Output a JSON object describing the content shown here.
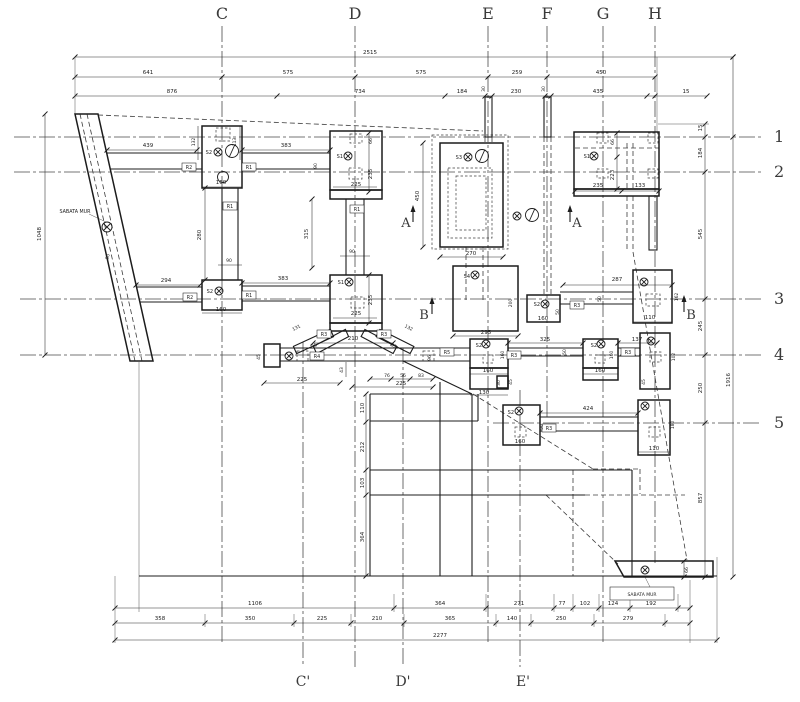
{
  "colors": {
    "line": "#1c1c1c",
    "grid": "#4a4a4a",
    "dim": "#2a2a2a",
    "background": "#ffffff"
  },
  "grid": {
    "columns": [
      "C",
      "D",
      "E",
      "F",
      "G",
      "H"
    ],
    "rows": [
      "1",
      "2",
      "3",
      "4",
      "5"
    ],
    "bottom_columns": [
      "C'",
      "D'",
      "E'"
    ]
  },
  "wall_label": "SABATA MUR",
  "texts": [
    {
      "n": "grid-col-c",
      "s": "C",
      "x": 222,
      "y": 19,
      "fs": 16,
      "cls": "g"
    },
    {
      "n": "grid-col-d",
      "s": "D",
      "x": 355,
      "y": 19,
      "fs": 16,
      "cls": "g"
    },
    {
      "n": "grid-col-e",
      "s": "E",
      "x": 488,
      "y": 19,
      "fs": 16,
      "cls": "g"
    },
    {
      "n": "grid-col-f",
      "s": "F",
      "x": 547,
      "y": 19,
      "fs": 16,
      "cls": "g"
    },
    {
      "n": "grid-col-g",
      "s": "G",
      "x": 603,
      "y": 19,
      "fs": 16,
      "cls": "g"
    },
    {
      "n": "grid-col-h",
      "s": "H",
      "x": 655,
      "y": 19,
      "fs": 16,
      "cls": "g"
    },
    {
      "n": "grid-row-1",
      "s": "1",
      "x": 774,
      "y": 142,
      "fs": 16,
      "cls": "g",
      "a": "s"
    },
    {
      "n": "grid-row-2",
      "s": "2",
      "x": 774,
      "y": 177,
      "fs": 16,
      "cls": "g",
      "a": "s"
    },
    {
      "n": "grid-row-3",
      "s": "3",
      "x": 774,
      "y": 304,
      "fs": 16,
      "cls": "g",
      "a": "s"
    },
    {
      "n": "grid-row-4",
      "s": "4",
      "x": 774,
      "y": 360,
      "fs": 16,
      "cls": "g",
      "a": "s"
    },
    {
      "n": "grid-row-5",
      "s": "5",
      "x": 774,
      "y": 428,
      "fs": 16,
      "cls": "g",
      "a": "s"
    },
    {
      "n": "grid-col-c-prime",
      "s": "C'",
      "x": 303,
      "y": 686,
      "fs": 14,
      "cls": "g"
    },
    {
      "n": "grid-col-d-prime",
      "s": "D'",
      "x": 403,
      "y": 686,
      "fs": 14,
      "cls": "g"
    },
    {
      "n": "grid-col-e-prime",
      "s": "E'",
      "x": 523,
      "y": 686,
      "fs": 14,
      "cls": "g"
    },
    {
      "n": "dim-total-top",
      "s": "2515",
      "x": 370,
      "y": 54
    },
    {
      "n": "dim-top-641",
      "s": "641",
      "x": 148,
      "y": 74
    },
    {
      "n": "dim-top-575a",
      "s": "575",
      "x": 288,
      "y": 74
    },
    {
      "n": "dim-top-575b",
      "s": "575",
      "x": 421,
      "y": 74
    },
    {
      "n": "dim-top-259",
      "s": "259",
      "x": 517,
      "y": 74
    },
    {
      "n": "dim-top-450",
      "s": "450",
      "x": 601,
      "y": 74
    },
    {
      "n": "dim-top-876",
      "s": "876",
      "x": 172,
      "y": 93
    },
    {
      "n": "dim-top-734",
      "s": "734",
      "x": 360,
      "y": 93
    },
    {
      "n": "dim-top-184",
      "s": "184",
      "x": 462,
      "y": 93
    },
    {
      "n": "dim-top-230",
      "s": "230",
      "x": 516,
      "y": 93
    },
    {
      "n": "dim-top-435",
      "s": "435",
      "x": 598,
      "y": 93
    },
    {
      "n": "dim-top-15",
      "s": "15",
      "x": 686,
      "y": 93
    },
    {
      "n": "dim-top-30a",
      "s": "30",
      "x": 485,
      "y": 89,
      "r": -90,
      "fs": 4.5
    },
    {
      "n": "dim-top-30b",
      "s": "30",
      "x": 545,
      "y": 89,
      "r": -90,
      "fs": 4.5
    },
    {
      "n": "dim-right-15",
      "s": "15",
      "x": 702,
      "y": 128,
      "r": -90
    },
    {
      "n": "dim-right-184",
      "s": "184",
      "x": 702,
      "y": 153,
      "r": -90
    },
    {
      "n": "dim-right-545",
      "s": "545",
      "x": 702,
      "y": 234,
      "r": -90
    },
    {
      "n": "dim-right-245",
      "s": "245",
      "x": 702,
      "y": 326,
      "r": -90
    },
    {
      "n": "dim-right-250",
      "s": "250",
      "x": 702,
      "y": 388,
      "r": -90
    },
    {
      "n": "dim-right-857",
      "s": "857",
      "x": 702,
      "y": 498,
      "r": -90
    },
    {
      "n": "dim-right-1916",
      "s": "1916",
      "x": 730,
      "y": 380,
      "r": -90
    },
    {
      "n": "dim-left-1048",
      "s": "1048",
      "x": 41,
      "y": 234,
      "r": -90
    },
    {
      "n": "dim-bot-1106",
      "s": "1106",
      "x": 255,
      "y": 605
    },
    {
      "n": "dim-bot-364",
      "s": "364",
      "x": 440,
      "y": 605
    },
    {
      "n": "dim-bot-271",
      "s": "271",
      "x": 519,
      "y": 605
    },
    {
      "n": "dim-bot-77",
      "s": "77",
      "x": 562,
      "y": 605
    },
    {
      "n": "dim-bot-102",
      "s": "102",
      "x": 585,
      "y": 605
    },
    {
      "n": "dim-bot-124",
      "s": "124",
      "x": 613,
      "y": 605
    },
    {
      "n": "dim-bot-192",
      "s": "192",
      "x": 651,
      "y": 605
    },
    {
      "n": "dim-bot-358",
      "s": "358",
      "x": 160,
      "y": 620
    },
    {
      "n": "dim-bot-350",
      "s": "350",
      "x": 250,
      "y": 620
    },
    {
      "n": "dim-bot-225",
      "s": "225",
      "x": 322,
      "y": 620
    },
    {
      "n": "dim-bot-210",
      "s": "210",
      "x": 377,
      "y": 620
    },
    {
      "n": "dim-bot-365",
      "s": "365",
      "x": 450,
      "y": 620
    },
    {
      "n": "dim-bot-140",
      "s": "140",
      "x": 512,
      "y": 620
    },
    {
      "n": "dim-bot-250",
      "s": "250",
      "x": 561,
      "y": 620
    },
    {
      "n": "dim-bot-279",
      "s": "279",
      "x": 628,
      "y": 620
    },
    {
      "n": "dim-total-bottom",
      "s": "2277",
      "x": 440,
      "y": 637
    },
    {
      "n": "wall-label-left",
      "s": "SABATA MUR",
      "x": 75,
      "y": 213,
      "fs": 4.8
    },
    {
      "n": "wall-dim-50",
      "s": "50",
      "x": 109,
      "y": 257,
      "r": -75,
      "fs": 4.5
    },
    {
      "n": "dim-439",
      "s": "439",
      "x": 148,
      "y": 147
    },
    {
      "n": "dim-132",
      "s": "132",
      "x": 195,
      "y": 142,
      "r": -90,
      "fs": 4.5
    },
    {
      "n": "dim-113",
      "s": "113",
      "x": 236,
      "y": 142,
      "r": -90,
      "fs": 4.5
    },
    {
      "n": "label-s2-c2",
      "s": "S2",
      "x": 212,
      "y": 154,
      "a": "e",
      "fs": 5
    },
    {
      "n": "dim-160-c2",
      "s": "160",
      "x": 221,
      "y": 184
    },
    {
      "n": "dim-383-r2",
      "s": "383",
      "x": 286,
      "y": 147
    },
    {
      "n": "dim-90-r2",
      "s": "90",
      "x": 317,
      "y": 166,
      "r": -90,
      "fs": 4.5
    },
    {
      "n": "dim-280-c",
      "s": "280",
      "x": 201,
      "y": 235,
      "r": -90
    },
    {
      "n": "dim-90-c",
      "s": "90",
      "x": 229,
      "y": 262,
      "fs": 4.5
    },
    {
      "n": "dim-294",
      "s": "294",
      "x": 166,
      "y": 282
    },
    {
      "n": "label-s2-c3",
      "s": "S2",
      "x": 213,
      "y": 293,
      "a": "e",
      "fs": 5
    },
    {
      "n": "dim-160-c3",
      "s": "160",
      "x": 221,
      "y": 311
    },
    {
      "n": "dim-383-r3",
      "s": "383",
      "x": 283,
      "y": 280
    },
    {
      "n": "label-s1-d2",
      "s": "S1",
      "x": 343,
      "y": 158,
      "a": "e",
      "fs": 5
    },
    {
      "n": "dim-66-d2",
      "s": "66",
      "x": 372,
      "y": 141,
      "r": -90,
      "fs": 4.5
    },
    {
      "n": "dim-235-d2",
      "s": "235",
      "x": 372,
      "y": 174,
      "r": -90
    },
    {
      "n": "dim-225-d2",
      "s": "225",
      "x": 356,
      "y": 186
    },
    {
      "n": "dim-315",
      "s": "315",
      "x": 308,
      "y": 234,
      "r": -90
    },
    {
      "n": "dim-90-d",
      "s": "90",
      "x": 352,
      "y": 253,
      "fs": 4.5
    },
    {
      "n": "label-s1-d3",
      "s": "S1",
      "x": 344,
      "y": 284,
      "a": "e",
      "fs": 5
    },
    {
      "n": "dim-235-d3",
      "s": "235",
      "x": 372,
      "y": 300,
      "r": -90
    },
    {
      "n": "dim-225-d3",
      "s": "225",
      "x": 356,
      "y": 315
    },
    {
      "n": "dim-131",
      "s": "131",
      "x": 297,
      "y": 329,
      "r": -28,
      "fs": 4.5
    },
    {
      "n": "dim-132b",
      "s": "132",
      "x": 408,
      "y": 329,
      "r": 28,
      "fs": 4.5
    },
    {
      "n": "dim-35a",
      "s": "35",
      "x": 315,
      "y": 347,
      "r": -28,
      "fs": 4.5
    },
    {
      "n": "dim-35b",
      "s": "35",
      "x": 393,
      "y": 347,
      "r": 28,
      "fs": 4.5
    },
    {
      "n": "dim-210-braces",
      "s": "210",
      "x": 353,
      "y": 340
    },
    {
      "n": "dim-45-beam-end",
      "s": "45",
      "x": 260,
      "y": 357,
      "r": -90,
      "fs": 4.5
    },
    {
      "n": "dim-225-beam",
      "s": "225",
      "x": 302,
      "y": 381
    },
    {
      "n": "dim-43",
      "s": "43",
      "x": 343,
      "y": 370,
      "r": -90,
      "fs": 4.5
    },
    {
      "n": "dim-76",
      "s": "76",
      "x": 387,
      "y": 377,
      "fs": 4.5
    },
    {
      "n": "dim-56",
      "s": "56",
      "x": 403,
      "y": 377,
      "fs": 4.5
    },
    {
      "n": "dim-83",
      "s": "83",
      "x": 421,
      "y": 377,
      "fs": 4.5
    },
    {
      "n": "dim-225-plat",
      "s": "225",
      "x": 401,
      "y": 385
    },
    {
      "n": "dim-110-plat",
      "s": "110",
      "x": 364,
      "y": 408,
      "r": -90
    },
    {
      "n": "dim-212-plat",
      "s": "212",
      "x": 364,
      "y": 447,
      "r": -90
    },
    {
      "n": "dim-103-plat",
      "s": "103",
      "x": 364,
      "y": 483,
      "r": -90
    },
    {
      "n": "dim-364-plat",
      "s": "364",
      "x": 364,
      "y": 537,
      "r": -90
    },
    {
      "n": "label-s3",
      "s": "S3",
      "x": 462,
      "y": 159,
      "a": "e",
      "fs": 5
    },
    {
      "n": "dim-450-s3",
      "s": "450",
      "x": 419,
      "y": 196,
      "r": -90
    },
    {
      "n": "dim-270-s3",
      "s": "270",
      "x": 471,
      "y": 255
    },
    {
      "n": "section-a-left",
      "s": "A",
      "x": 406,
      "y": 227,
      "fs": 13,
      "cls": "g"
    },
    {
      "n": "section-a-right",
      "s": "A",
      "x": 577,
      "y": 227,
      "fs": 13,
      "cls": "g"
    },
    {
      "n": "label-s4",
      "s": "S4",
      "x": 470,
      "y": 278,
      "a": "e",
      "fs": 5
    },
    {
      "n": "dim-295-s4",
      "s": "295",
      "x": 486,
      "y": 334
    },
    {
      "n": "dim-200-s4",
      "s": "200",
      "x": 512,
      "y": 303,
      "r": -90,
      "fs": 4.5
    },
    {
      "n": "label-s2-f3",
      "s": "S2",
      "x": 540,
      "y": 306,
      "a": "e",
      "fs": 5
    },
    {
      "n": "dim-160-f3",
      "s": "160",
      "x": 543,
      "y": 320
    },
    {
      "n": "dim-50-f3",
      "s": "50",
      "x": 559,
      "y": 312,
      "r": -90,
      "fs": 4.5
    },
    {
      "n": "dim-287",
      "s": "287",
      "x": 617,
      "y": 281
    },
    {
      "n": "dim-50-g3",
      "s": "50",
      "x": 601,
      "y": 299,
      "r": -90,
      "fs": 4.5
    },
    {
      "n": "dim-110-g3",
      "s": "110",
      "x": 650,
      "y": 319
    },
    {
      "n": "dim-162-g3",
      "s": "162",
      "x": 678,
      "y": 297,
      "r": -90,
      "fs": 4.5
    },
    {
      "n": "section-b-left",
      "s": "B",
      "x": 424,
      "y": 319,
      "fs": 13,
      "cls": "g"
    },
    {
      "n": "section-b-right",
      "s": "B",
      "x": 691,
      "y": 319,
      "fs": 13,
      "cls": "g"
    },
    {
      "n": "dim-96",
      "s": "96",
      "x": 431,
      "y": 358,
      "r": -90,
      "fs": 4.5
    },
    {
      "n": "label-s2-x1",
      "s": "S2",
      "x": 482,
      "y": 347,
      "a": "e",
      "fs": 5
    },
    {
      "n": "dim-160-x1r",
      "s": "160",
      "x": 504,
      "y": 355,
      "r": -90,
      "fs": 4.5
    },
    {
      "n": "dim-160-x1",
      "s": "160",
      "x": 488,
      "y": 372
    },
    {
      "n": "dim-30-x1",
      "s": "30",
      "x": 500,
      "y": 383,
      "r": -90,
      "fs": 4.5
    },
    {
      "n": "dim-45-x1",
      "s": "45",
      "x": 512,
      "y": 382,
      "r": -90,
      "fs": 4.5
    },
    {
      "n": "dim-130-x1",
      "s": "130",
      "x": 484,
      "y": 394
    },
    {
      "n": "dim-325",
      "s": "325",
      "x": 545,
      "y": 341
    },
    {
      "n": "dim-50-x",
      "s": "50",
      "x": 566,
      "y": 352,
      "r": -90,
      "fs": 4.5
    },
    {
      "n": "label-s2-x2",
      "s": "S2",
      "x": 597,
      "y": 347,
      "a": "e",
      "fs": 5
    },
    {
      "n": "dim-160-x2r",
      "s": "160",
      "x": 613,
      "y": 355,
      "r": -90,
      "fs": 4.5
    },
    {
      "n": "dim-160-x2",
      "s": "160",
      "x": 600,
      "y": 372
    },
    {
      "n": "dim-137",
      "s": "137",
      "x": 637,
      "y": 341
    },
    {
      "n": "dim-102-r4",
      "s": "102",
      "x": 675,
      "y": 357,
      "r": -90,
      "fs": 4.5
    },
    {
      "n": "dim-45-r4",
      "s": "45",
      "x": 645,
      "y": 382,
      "r": -90,
      "fs": 4.5
    },
    {
      "n": "label-s2-r5",
      "s": "S2",
      "x": 514,
      "y": 414,
      "a": "e",
      "fs": 5
    },
    {
      "n": "dim-160-r5",
      "s": "160",
      "x": 520,
      "y": 443
    },
    {
      "n": "dim-90-r5",
      "s": "90",
      "x": 543,
      "y": 427,
      "r": -90,
      "fs": 4.5
    },
    {
      "n": "dim-424",
      "s": "424",
      "x": 588,
      "y": 410
    },
    {
      "n": "dim-110-r5",
      "s": "110",
      "x": 654,
      "y": 450
    },
    {
      "n": "dim-180-r5",
      "s": "180",
      "x": 674,
      "y": 425,
      "r": -90,
      "fs": 4.5
    },
    {
      "n": "label-s1-gh",
      "s": "S1",
      "x": 590,
      "y": 158,
      "a": "e",
      "fs": 5
    },
    {
      "n": "dim-66-gh",
      "s": "66",
      "x": 614,
      "y": 142,
      "r": -90,
      "fs": 4.5
    },
    {
      "n": "dim-223-gh",
      "s": "223",
      "x": 614,
      "y": 175,
      "r": -90
    },
    {
      "n": "dim-235-gh",
      "s": "235",
      "x": 598,
      "y": 187
    },
    {
      "n": "dim-133-gh",
      "s": "133",
      "x": 640,
      "y": 187
    },
    {
      "n": "dim-66-trap",
      "s": "66",
      "x": 688,
      "y": 570,
      "r": -90,
      "fs": 4.5
    },
    {
      "n": "wall-label-right",
      "s": "SABATA MUR",
      "x": 642,
      "y": 596,
      "fs": 4.5
    }
  ],
  "ref_boxes": [
    {
      "n": "beam-ref-r2-a",
      "s": "R2",
      "x": 189,
      "y": 167
    },
    {
      "n": "beam-ref-r1-a",
      "s": "R1",
      "x": 249,
      "y": 167
    },
    {
      "n": "beam-ref-r1-b",
      "s": "R1",
      "x": 230,
      "y": 206
    },
    {
      "n": "beam-ref-r1-c",
      "s": "R1",
      "x": 357,
      "y": 209
    },
    {
      "n": "beam-ref-r2-b",
      "s": "R2",
      "x": 190,
      "y": 297
    },
    {
      "n": "beam-ref-r1-d",
      "s": "R1",
      "x": 249,
      "y": 295
    },
    {
      "n": "beam-ref-r3-a",
      "s": "R3",
      "x": 324,
      "y": 334
    },
    {
      "n": "beam-ref-r3-b",
      "s": "R3",
      "x": 384,
      "y": 334
    },
    {
      "n": "beam-ref-r4",
      "s": "R4",
      "x": 317,
      "y": 356
    },
    {
      "n": "beam-ref-r5",
      "s": "R5",
      "x": 447,
      "y": 352
    },
    {
      "n": "beam-ref-r3-c",
      "s": "R3",
      "x": 514,
      "y": 355
    },
    {
      "n": "beam-ref-r3-d",
      "s": "R3",
      "x": 577,
      "y": 305
    },
    {
      "n": "beam-ref-r3-e",
      "s": "R3",
      "x": 628,
      "y": 352
    },
    {
      "n": "beam-ref-r3-f",
      "s": "R3",
      "x": 549,
      "y": 428
    }
  ],
  "symbols": [
    {
      "t": "x",
      "x": 107,
      "y": 227,
      "r": 5
    },
    {
      "t": "x",
      "x": 218,
      "y": 152
    },
    {
      "t": "slash",
      "x": 232,
      "y": 151
    },
    {
      "t": "plain",
      "x": 223,
      "y": 177
    },
    {
      "t": "x",
      "x": 219,
      "y": 291
    },
    {
      "t": "x",
      "x": 348,
      "y": 156
    },
    {
      "t": "x",
      "x": 349,
      "y": 282
    },
    {
      "t": "x",
      "x": 468,
      "y": 157
    },
    {
      "t": "slash",
      "x": 482,
      "y": 156
    },
    {
      "t": "x",
      "x": 517,
      "y": 216
    },
    {
      "t": "slash",
      "x": 532,
      "y": 215
    },
    {
      "t": "x",
      "x": 475,
      "y": 275
    },
    {
      "t": "x",
      "x": 594,
      "y": 156
    },
    {
      "t": "x",
      "x": 545,
      "y": 304
    },
    {
      "t": "x",
      "x": 644,
      "y": 282
    },
    {
      "t": "x",
      "x": 486,
      "y": 344
    },
    {
      "t": "x",
      "x": 601,
      "y": 344
    },
    {
      "t": "x",
      "x": 651,
      "y": 341
    },
    {
      "t": "x",
      "x": 519,
      "y": 411
    },
    {
      "t": "x",
      "x": 645,
      "y": 406
    },
    {
      "t": "x",
      "x": 289,
      "y": 356
    },
    {
      "t": "x",
      "x": 645,
      "y": 570
    }
  ]
}
